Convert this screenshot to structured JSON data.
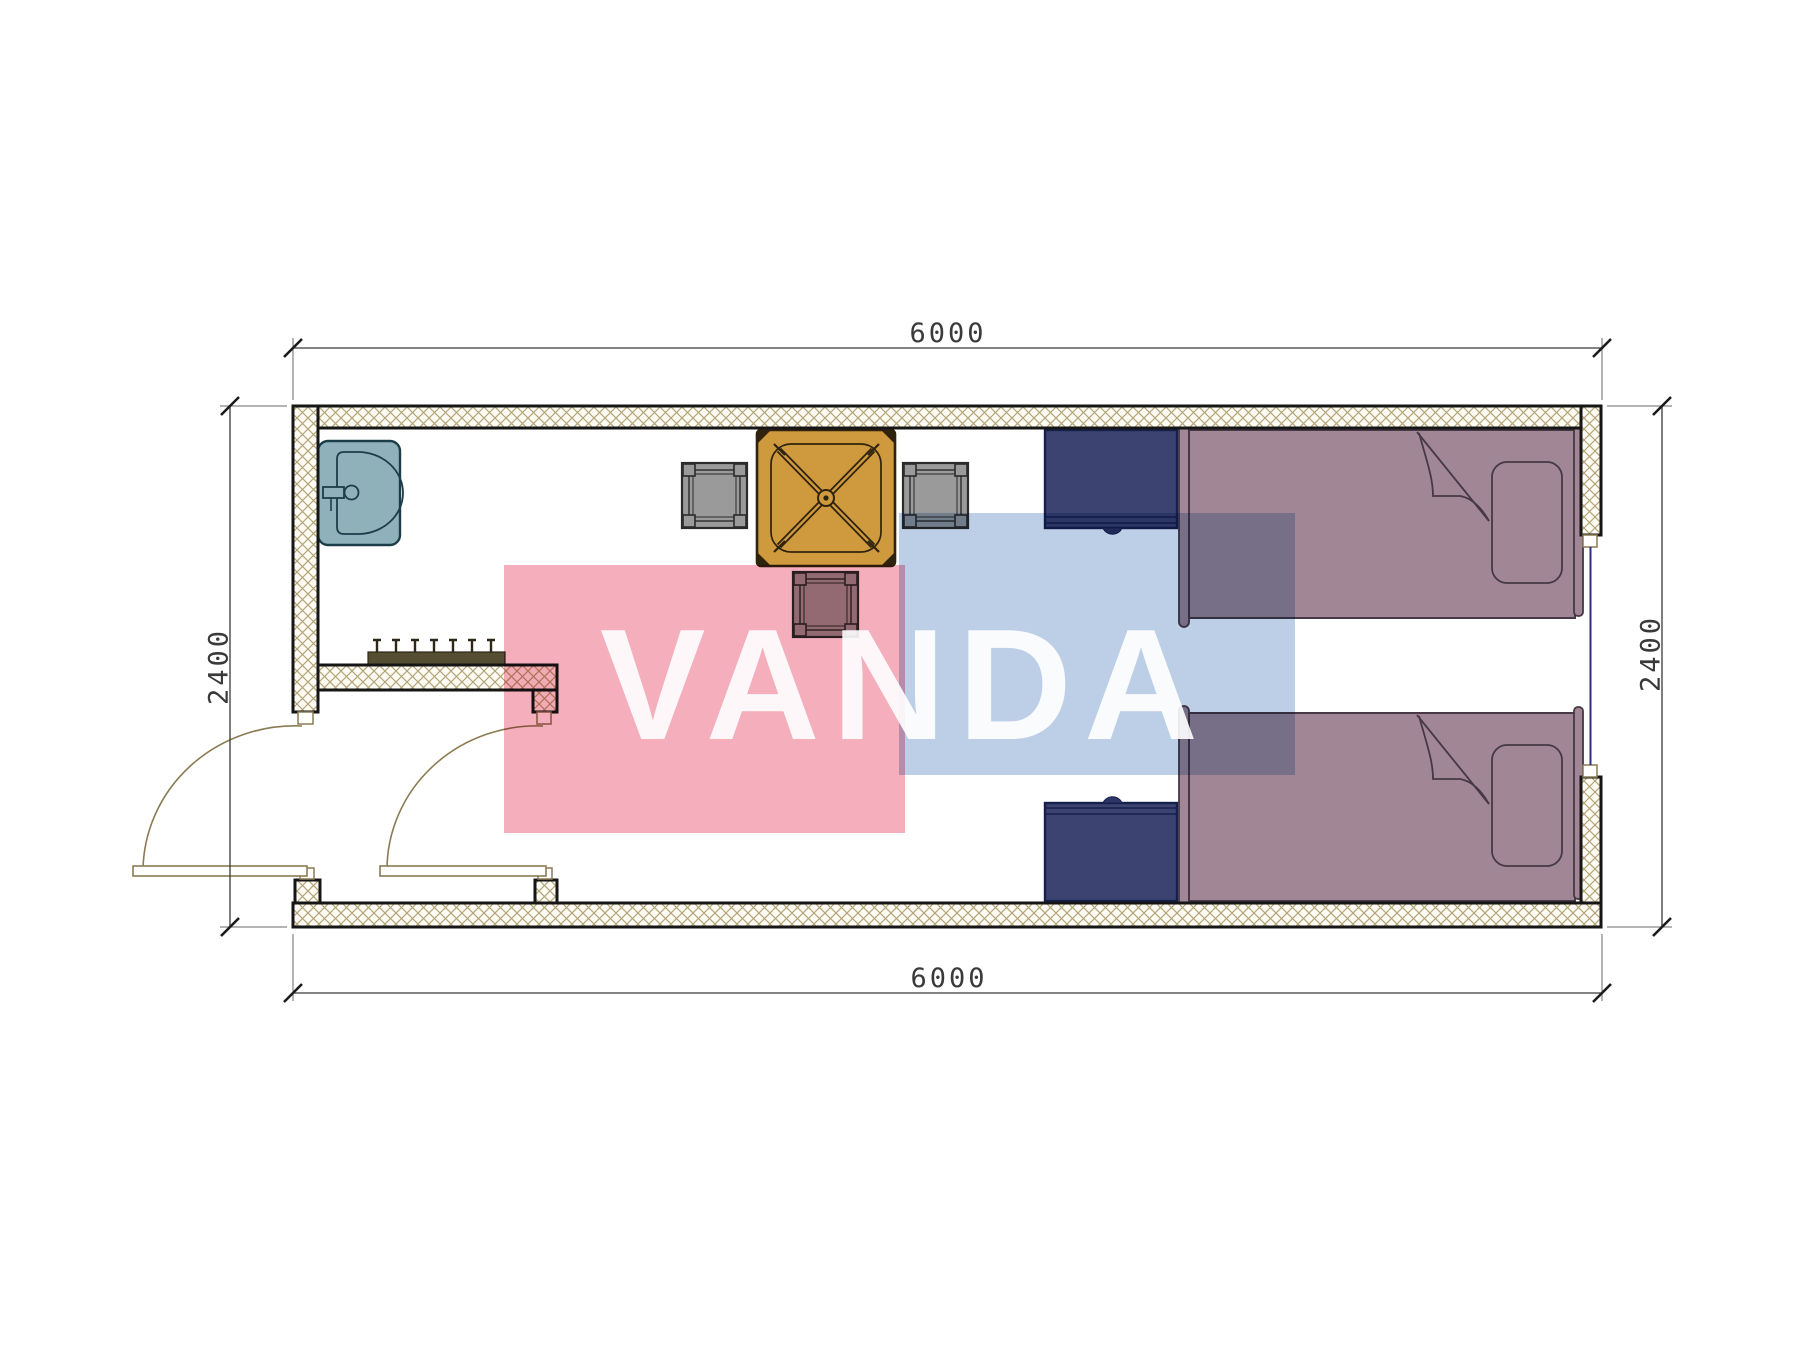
{
  "title": "container-cabin-floor-plan",
  "dimensions": {
    "top": "6000",
    "bottom": "6000",
    "left": "2400",
    "right": "2400"
  },
  "watermark": {
    "text": "VANDA",
    "pink_color": "#f4aebc",
    "blue_color": "#bdcfe7",
    "text_color": "rgba(255,255,255,0.9)"
  },
  "palette": {
    "wall_outline": "#161616",
    "wall_hatch_line": "#b3a578",
    "wall_fill": "#fdfbf4",
    "sink_fill": "#8fb2ba",
    "sink_line": "#1d3d49",
    "table_fill": "#cf9a3d",
    "table_line": "#30230d",
    "chair_fill": "#9a9a9a",
    "chair_line": "#2b2b2b",
    "nightstand_fill": "#3c4370",
    "nightstand_line": "#16204d",
    "bed_fill": "#a18795",
    "bed_line": "#463844",
    "window_glass": "#2e2e82",
    "door_swing": "#8a7b52",
    "dimension_line": "#3a3a3a",
    "coat_rack": "#564e33"
  },
  "furniture": [
    "sink",
    "dining-table",
    "chair-left",
    "chair-right",
    "chair-bottom",
    "coat-rack",
    "nightstand-top",
    "nightstand-bottom",
    "bed-top",
    "bed-bottom"
  ],
  "openings": [
    "entry-door",
    "interior-door",
    "window"
  ]
}
